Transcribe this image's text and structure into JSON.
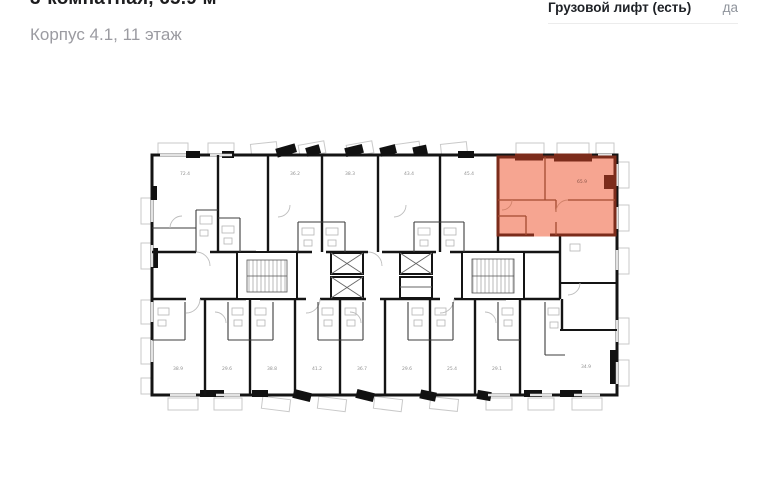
{
  "header": {
    "title": "3-комнатная, 65.9 м²",
    "subtitle": "Корпус 4.1, 11 этаж"
  },
  "specs": {
    "freight_elevator": {
      "label": "Грузовой лифт (есть)",
      "value": "да"
    }
  },
  "floorplan": {
    "highlighted_unit": {
      "area_label": "65.9",
      "fill_color": "#f6a591",
      "wall_color": "#7c2c1b"
    },
    "top_unit_labels": [
      "72.4",
      "36.2",
      "38.3",
      "43.4",
      "45.4"
    ],
    "bottom_unit_labels": [
      "38.9",
      "29.6",
      "38.8",
      "41.2",
      "36.7",
      "29.6",
      "25.4",
      "29.1",
      "34.9"
    ],
    "wall_color": "#141414"
  }
}
